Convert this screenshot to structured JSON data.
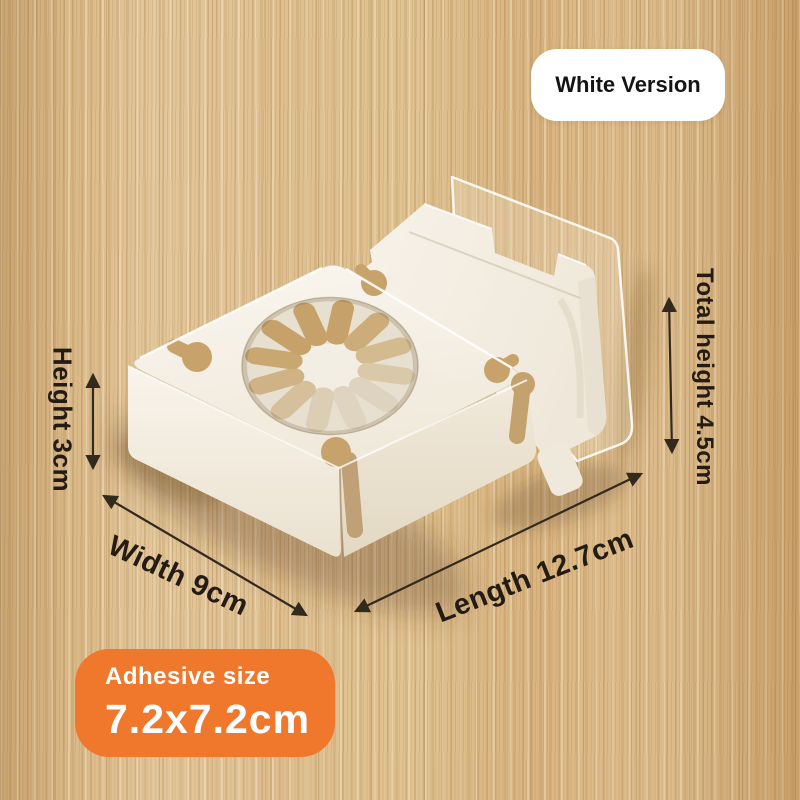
{
  "version_badge": {
    "label": "White Version"
  },
  "dimension_labels": {
    "height": "Height 3cm",
    "total_height": "Total height 4.5cm",
    "width": "Width 9cm",
    "length": "Length 12.7cm"
  },
  "adhesive_badge": {
    "title": "Adhesive size",
    "size": "7.2x7.2cm"
  },
  "colors": {
    "accent_orange": "#f0782c",
    "badge_background": "#ffffff",
    "annotation_text": "#241c13",
    "product_plastic": "#f5f0e7",
    "wood_light": "#e6c998",
    "wood_dark": "#c49a63"
  }
}
